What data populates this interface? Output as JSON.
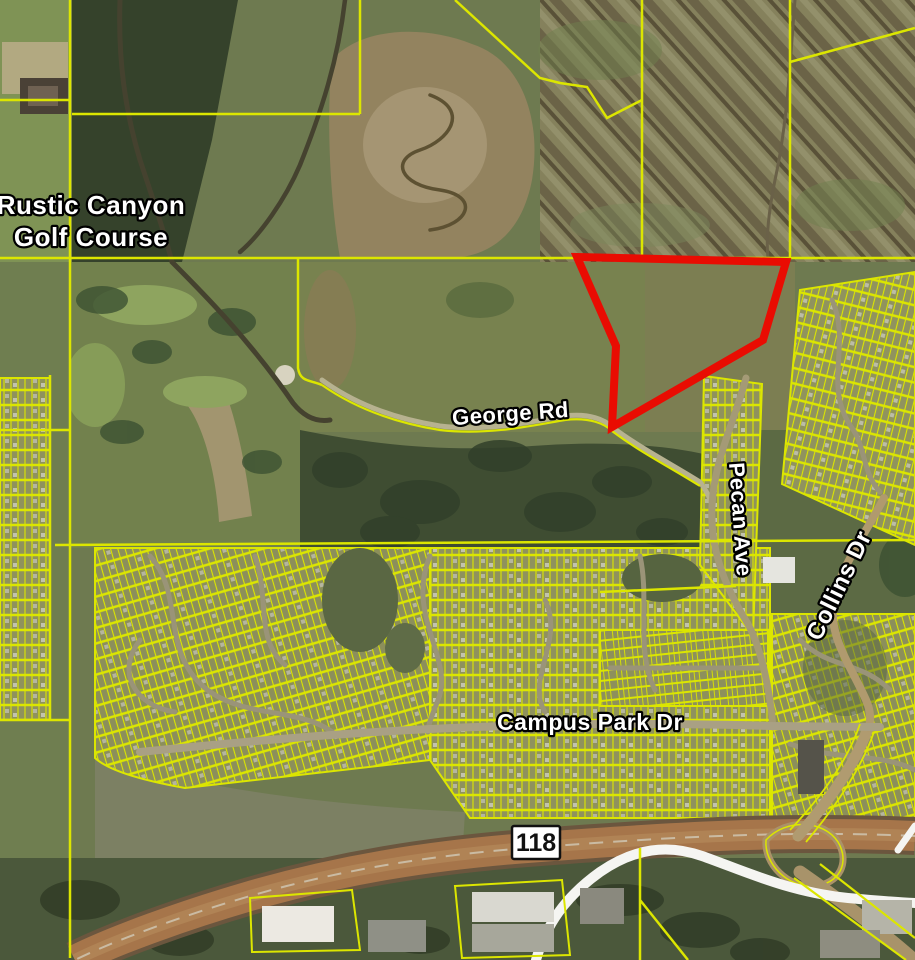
{
  "map": {
    "labels": {
      "golf_course": {
        "line1": "Rustic Canyon",
        "line2": "Golf Course"
      },
      "george_rd": "George Rd",
      "campus_park_dr": "Campus Park Dr",
      "pecan_ave": "Pecan Ave",
      "collins_dr": "Collins Dr",
      "highway_shield": "118"
    },
    "highlight_parcel": {
      "color": "#e90c02",
      "points": "577,257 786,262 763,340 612,427 616,346"
    },
    "colors": {
      "parcel_line": "#dce600",
      "label_text": "#ffffff",
      "label_outline": "#000000",
      "shield_bg": "#ffffff",
      "shield_text": "#111111",
      "freeway": "#a6754a",
      "pipeline": "#f5f5f2"
    }
  }
}
